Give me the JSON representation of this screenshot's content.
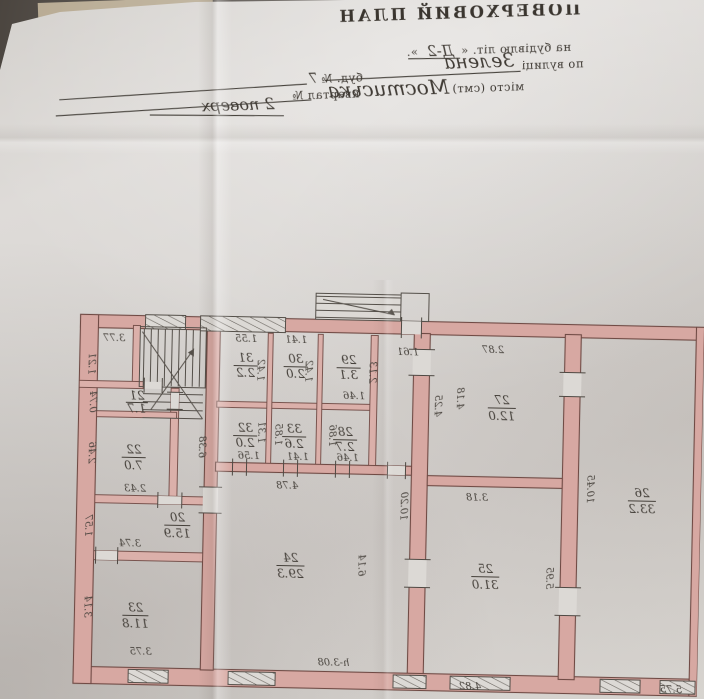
{
  "header": {
    "title": "ПОВЕРХОВИЙ ПЛАН",
    "building_label": "на будівлю літ. «",
    "building_value": "Д-2",
    "building_close": "».",
    "street_label": "по вулиці",
    "street_value": "Зелена",
    "house_label": "буд. №",
    "house_value": "7",
    "city_label": "місто (смт)",
    "city_value": "Мостиська",
    "quarter_label": "квартал №",
    "floor_note": "2 поверх"
  },
  "plan": {
    "rooms": [
      {
        "number": "20",
        "area": "15.9",
        "dims": [
          "1.57",
          "3.74"
        ]
      },
      {
        "number": "21",
        "area": "1.7",
        "dims": [
          "0.74"
        ]
      },
      {
        "number": "22",
        "area": "7.0",
        "dims": [
          "2.46",
          "2.43"
        ]
      },
      {
        "number": "23",
        "area": "11.8",
        "dims": [
          "3.14",
          "3.75"
        ]
      },
      {
        "number": "24",
        "area": "29.3",
        "dims": [
          "4.78",
          "6.14",
          "10.20"
        ],
        "note": "h-3.08"
      },
      {
        "number": "25",
        "area": "31.0",
        "dims": [
          "3.18",
          "5.95",
          "4.82"
        ]
      },
      {
        "number": "26",
        "area": "33.2",
        "dims": [
          "10.45",
          "5.75"
        ]
      },
      {
        "number": "27",
        "area": "12.0",
        "dims": [
          "2.87",
          "4.18",
          "4.25",
          "1.61"
        ]
      },
      {
        "number": "28",
        "area": "2.7",
        "dims": [
          "1.86",
          "1.46"
        ]
      },
      {
        "number": "29",
        "area": "3.1",
        "dims": [
          "2.13",
          "1.46"
        ]
      },
      {
        "number": "30",
        "area": "2.0",
        "dims": [
          "1.41",
          "1.42"
        ]
      },
      {
        "number": "31",
        "area": "2.2",
        "dims": [
          "1.55",
          "1.42"
        ]
      },
      {
        "number": "32",
        "area": "2.0",
        "dims": [
          "1.31",
          "1.56"
        ]
      },
      {
        "number": "33",
        "area": "2.6",
        "dims": [
          "1.85",
          "1.41"
        ]
      }
    ],
    "misc": {
      "stair_width": "3.77",
      "stair_depth": "1.21",
      "hall_length": "6.38"
    }
  }
}
